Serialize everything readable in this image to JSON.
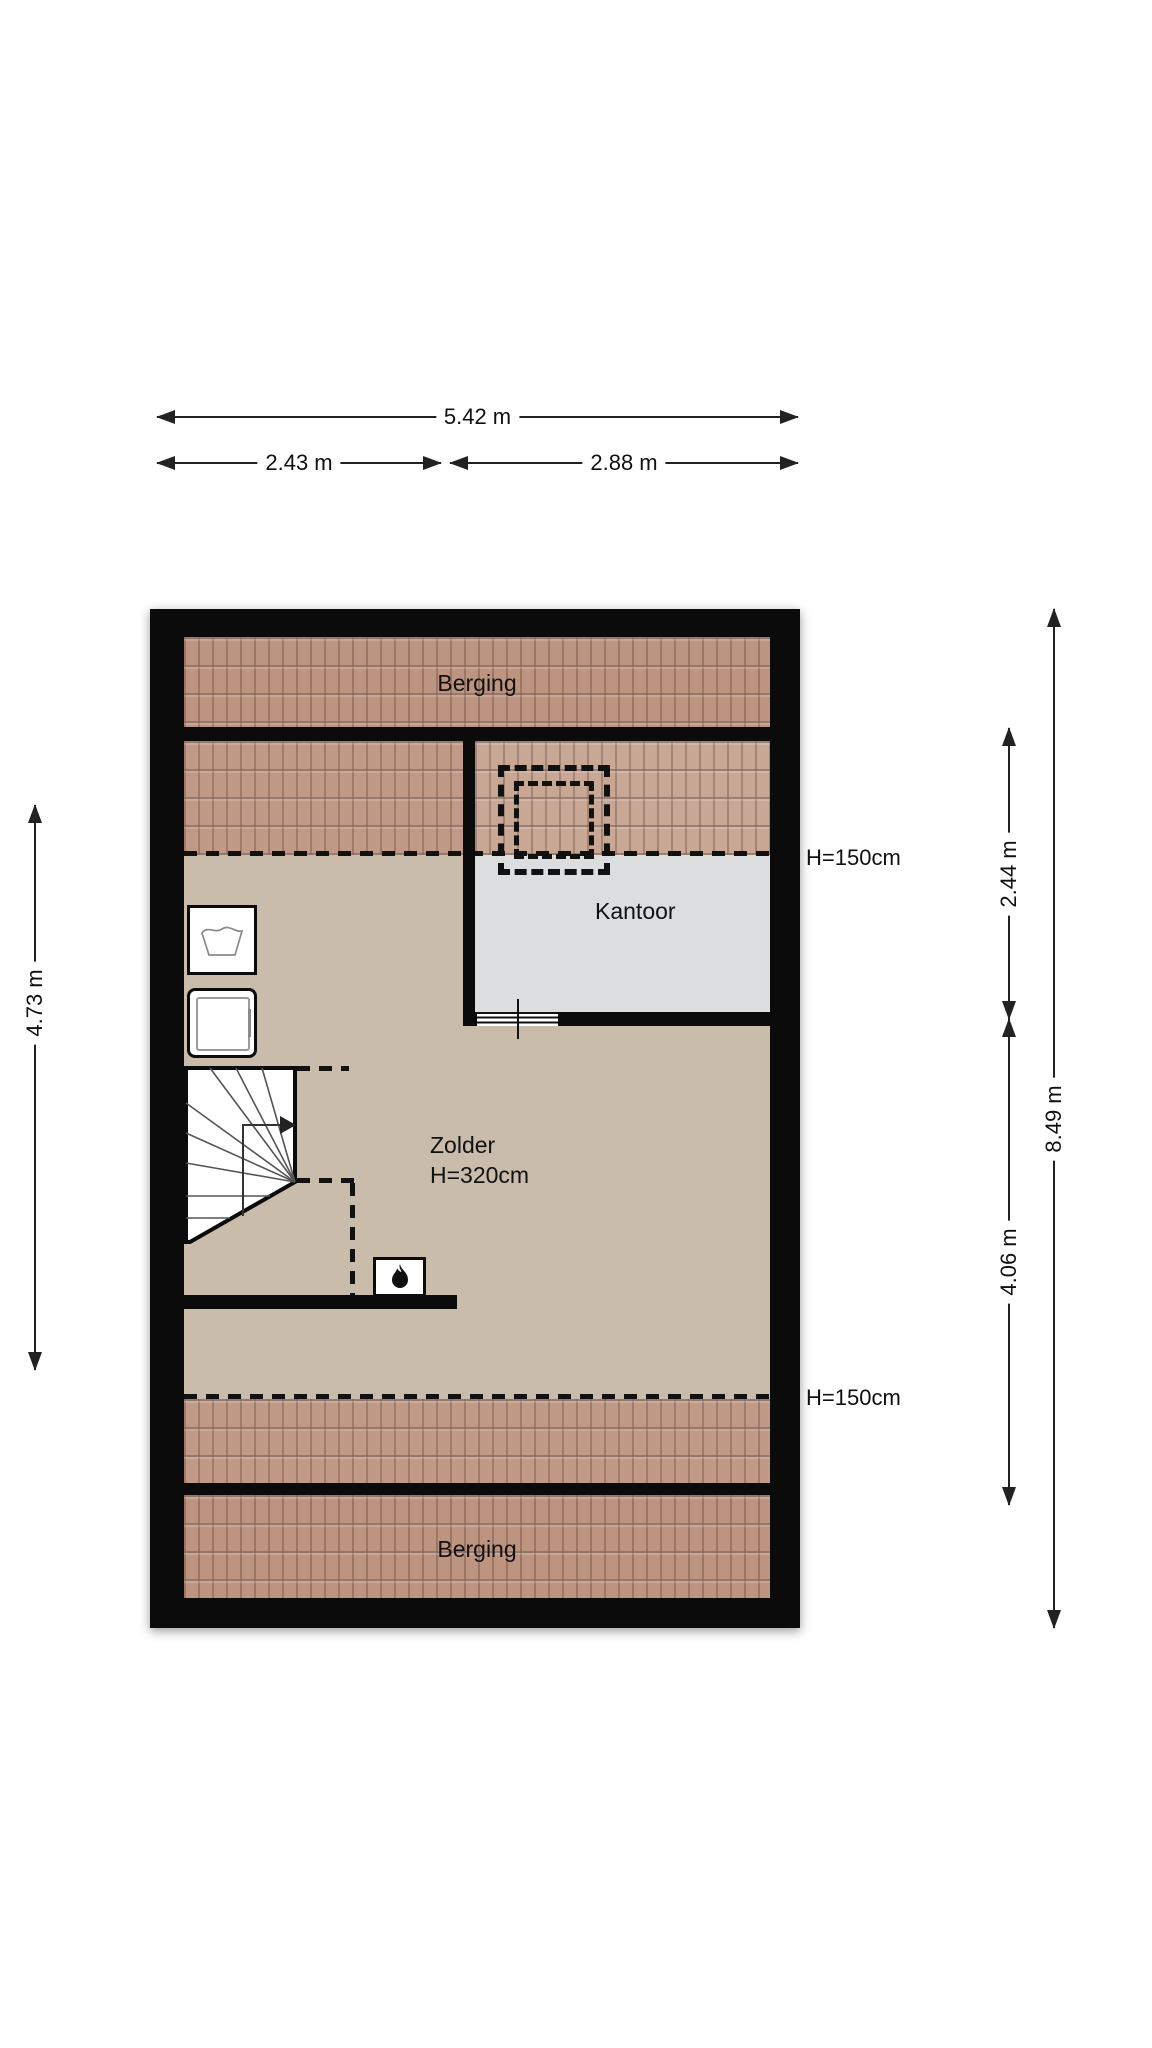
{
  "palette": {
    "wall": "#0b0b0b",
    "tile": "#bd9480",
    "tile_mid": "#c19a87",
    "tile_light": "#c9a795",
    "floor_tan": "#c9bcab",
    "floor_grey": "#dcddde",
    "line": "#222222",
    "background": "#ffffff"
  },
  "dimensions": {
    "top_total": {
      "label": "5.42 m"
    },
    "top_left": {
      "label": "2.43 m"
    },
    "top_right": {
      "label": "2.88 m"
    },
    "left_side": {
      "label": "4.73 m"
    },
    "right_upper": {
      "label": "2.44 m"
    },
    "right_lower": {
      "label": "4.06 m"
    },
    "right_total": {
      "label": "8.49 m"
    }
  },
  "rooms": {
    "berging_top": {
      "label": "Berging"
    },
    "kantoor": {
      "label": "Kantoor"
    },
    "zolder": {
      "label": "Zolder",
      "height": "H=320cm"
    },
    "berging_bottom": {
      "label": "Berging"
    }
  },
  "height_labels": {
    "upper": "H=150cm",
    "lower": "H=150cm"
  },
  "icons": {
    "washing_machine": "laundry-tub-symbol",
    "dryer": "front-load-appliance",
    "stove": "flame-symbol",
    "stairs": "winder-stairs-with-walk-line",
    "roof_window": "double-dashed-rectangle"
  }
}
